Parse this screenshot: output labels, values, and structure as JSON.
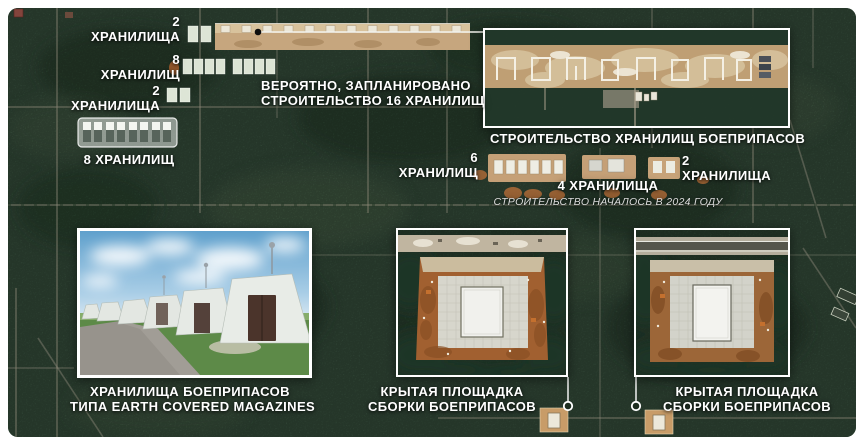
{
  "colors": {
    "frame_background": "#ffffff",
    "map_forest": "#3c5743",
    "label_text": "#ffffff",
    "note_text": "#dcdcdc",
    "inset_border": "#ffffff",
    "construction_soil": "#bf9f74"
  },
  "annotations": {
    "top_left": [
      {
        "count": "2",
        "noun": "ХРАНИЛИЩА"
      },
      {
        "count": "8",
        "noun": "ХРАНИЛИЩ"
      },
      {
        "count": "2",
        "noun": "ХРАНИЛИЩА"
      }
    ],
    "eight_storages_row_label": "8 ХРАНИЛИЩ",
    "planned_line1": "ВЕРОЯТНО, ЗАПЛАНИРОВАНО",
    "planned_line2": "СТРОИТЕЛЬСТВО 16 ХРАНИЛИЩ",
    "construction_box_caption": "СТРОИТЕЛЬСТВО ХРАНИЛИЩ БОЕПРИПАСОВ",
    "six_storages": {
      "count": "6",
      "noun": "ХРАНИЛИЩ"
    },
    "four_storages": "4 ХРАНИЛИЩА",
    "two_storages_right": {
      "count": "2",
      "noun": "ХРАНИЛИЩА"
    },
    "construction_started_note": "СТРОИТЕЛЬСТВО НАЧАЛОСЬ В 2024 ГОДУ"
  },
  "insets": {
    "magazines_photo": {
      "caption_line1": "ХРАНИЛИЩА БОЕПРИПАСОВ",
      "caption_line2": "ТИПА EARTH COVERED MAGAZINES"
    },
    "assembly_area_left": {
      "caption_line1": "КРЫТАЯ ПЛОЩАДКА",
      "caption_line2": "СБОРКИ БОЕПРИПАСОВ"
    },
    "assembly_area_right": {
      "caption_line1": "КРЫТАЯ ПЛОЩАДКА",
      "caption_line2": "СБОРКИ БОЕПРИПАСОВ"
    }
  }
}
